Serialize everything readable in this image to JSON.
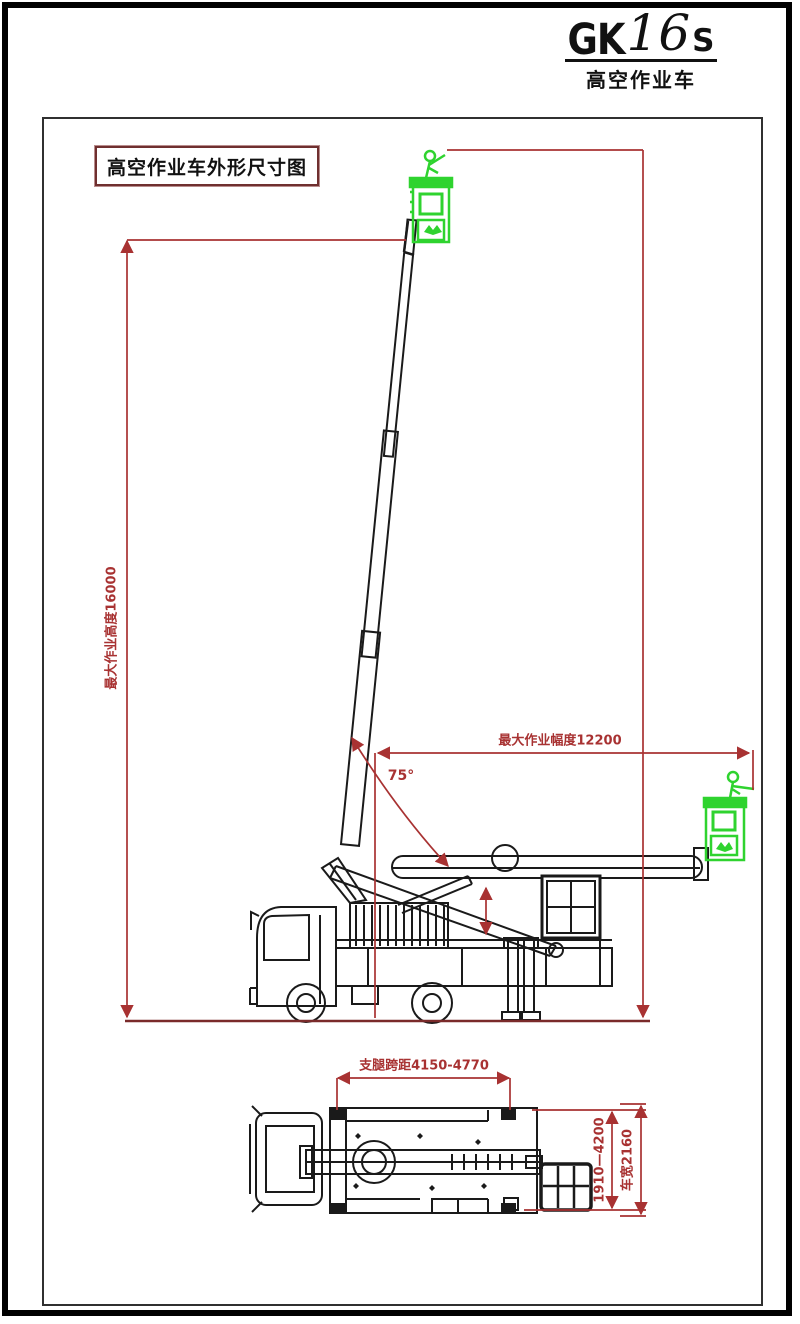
{
  "logo": {
    "prefix": "GK",
    "number": "16",
    "suffix": "S",
    "subtitle": "高空作业车"
  },
  "title_box": {
    "label": "高空作业车外形尺寸图"
  },
  "side_view": {
    "height_dimension": "最大作业高度16000",
    "radius_dimension": "最大作业幅度12200",
    "boom_angle": "75°"
  },
  "plan_view": {
    "outrigger_span_dimension": "支腿跨距4150-4770",
    "support_span_dimension": "1910—4200",
    "vehicle_width_dimension": "车宽2160"
  },
  "colors": {
    "dimension_red": "#a83232",
    "ground_red": "#7a2a2a",
    "line_black": "#1a1a1a",
    "basket_green": "#2fd32f",
    "frame_gray": "#303030",
    "title_border": "#6f2f2f"
  }
}
